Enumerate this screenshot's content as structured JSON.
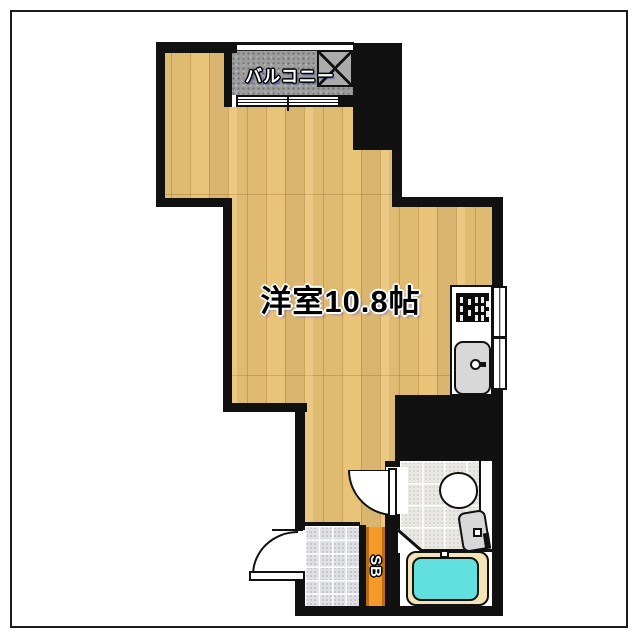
{
  "floorplan": {
    "labels": {
      "main_room": "洋室10.8帖",
      "balcony": "バルコニー",
      "shoe_box": "SB"
    },
    "colors": {
      "wall": "#111111",
      "wood_floor": "#e9c377",
      "balcony_floor": "#9d9d9d",
      "bath_tile": "#e9e8e3",
      "genkan_tile": "#dfdfe6",
      "shoe_box": "#f39a2b",
      "shoe_box_border": "#b96c12",
      "bathtub": "#62dfdf",
      "tub_deck": "#f2e4b6",
      "fixture_gray": "#d8d8d8"
    },
    "fixtures": [
      "balcony-hatch",
      "sliding-window",
      "kitchen-window",
      "stove",
      "kitchen-sink",
      "toilet",
      "bathtub",
      "entrance-door",
      "bathroom-door",
      "shoe-box"
    ]
  }
}
